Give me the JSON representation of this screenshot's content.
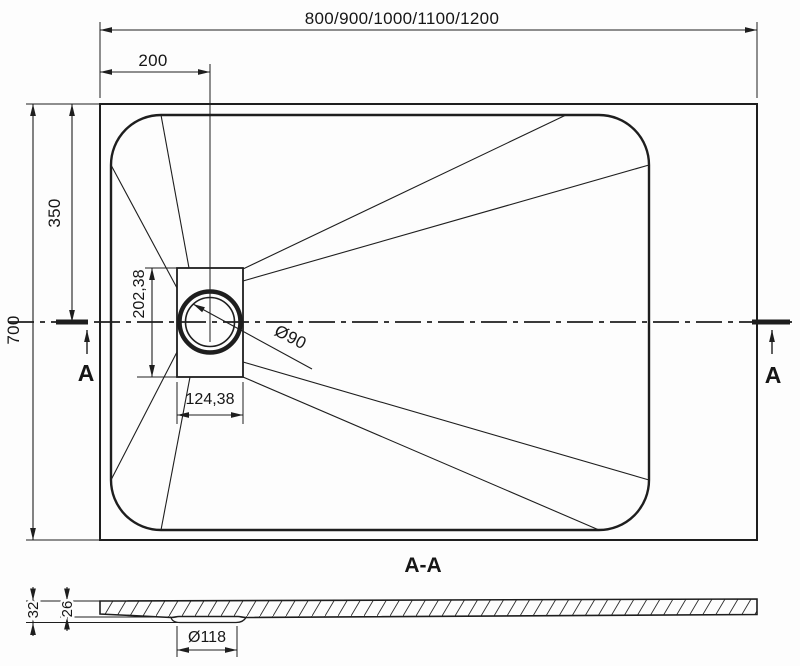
{
  "drawing": {
    "background": "#fdfdfd",
    "line_color": "#1e1e1e",
    "plan_view": {
      "overall_width_options": "800/900/1000/1100/1200",
      "drain_center_offset_x": "200",
      "drain_center_offset_y": "350",
      "overall_depth": "700",
      "drain_box_height": "202,38",
      "drain_box_width": "124,38",
      "drain_hole_diameter": "Ø90",
      "section_cut_label_left": "A",
      "section_cut_label_right": "A"
    },
    "section_view": {
      "title": "A-A",
      "total_thickness": "32",
      "slab_thickness": "26",
      "drain_recess_diameter": "Ø118"
    }
  }
}
